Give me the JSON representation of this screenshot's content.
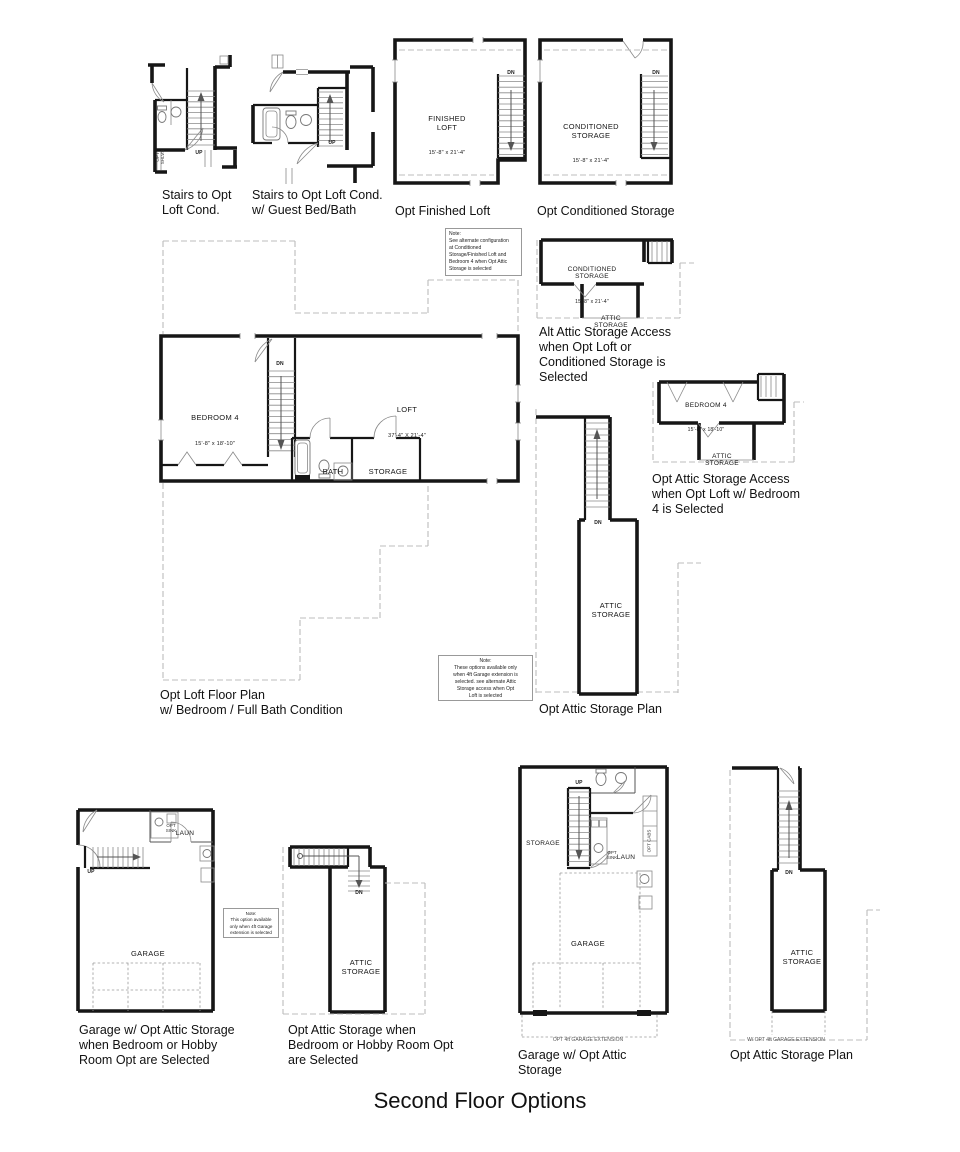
{
  "title": "Second Floor Options",
  "captions": {
    "stairs_loft": "Stairs to Opt\nLoft Cond.",
    "stairs_guest": "Stairs to Opt Loft Cond.\nw/ Guest Bed/Bath",
    "finished_loft": "Opt Finished Loft",
    "conditioned_storage": "Opt Conditioned Storage",
    "alt_attic_access": "Alt Attic Storage Access\nwhen Opt Loft or\nConditioned Storage is\nSelected",
    "attic_access_bedroom4": "Opt Attic Storage Access\nwhen Opt Loft w/ Bedroom\n4 is Selected",
    "loft_plan": "Opt Loft Floor Plan\nw/ Bedroom / Full Bath Condition",
    "attic_plan_mid": "Opt Attic Storage Plan",
    "garage_left": "Garage w/ Opt Attic Storage\nwhen Bedroom or Hobby\nRoom Opt are Selected",
    "attic_when": "Opt Attic Storage when\nBedroom or Hobby Room Opt\nare Selected",
    "garage_right": "Garage w/ Opt Attic\nStorage",
    "attic_plan_right": "Opt Attic Storage Plan"
  },
  "rooms": {
    "finished_loft": {
      "name": "FINISHED\nLOFT",
      "dims": "15'-8\" x 21'-4\""
    },
    "conditioned_storage": {
      "name": "CONDITIONED\nSTORAGE",
      "dims": "15'-8\" x 21'-4\""
    },
    "conditioned_storage_small": {
      "name": "CONDITIONED\nSTORAGE",
      "dims": "15'-8\" x 21'-4\""
    },
    "bedroom4_main": {
      "name": "BEDROOM 4",
      "dims": "15'-8\" x 18'-10\""
    },
    "bedroom4_small": {
      "name": "BEDROOM 4",
      "dims": "15'-8\" x 18'-10\""
    },
    "loft": {
      "name": "LOFT",
      "dims": "37'-4\" X 21'-4\""
    },
    "bath": "BATH",
    "storage": "STORAGE",
    "attic": "ATTIC\nSTORAGE",
    "garage": "GARAGE",
    "laun": "LAUN"
  },
  "labels": {
    "up": "UP",
    "dn": "DN",
    "opt_sink": "OPT\nSINK",
    "opt_cabs": "OPT CABS",
    "opt_shlvs": "OPT\nSHLVS",
    "garage_ext": "OPT 4ft GARAGE EXTENSION",
    "garage_ext_w": "W/ OPT 4ft GARAGE EXTENSION"
  },
  "notes": {
    "alt_config": "Note:\nSee alternate configuration\nat Conditioned\nStorage/Finished Loft and\nBedroom 4 when Opt Attic\nStorage is selected",
    "four_ft": "Note:\nThese options available only\nwhen 4ft Garage extension is\nselected. see alternate Attic\nStorage access when Opt\nLoft is selected",
    "four_ft_single": "Note:\nThis option available\nonly when 4ft Garage\nextension is selected"
  },
  "colors": {
    "line": "#161616",
    "thin": "#8a8a8a",
    "dash": "#bcbcbc"
  }
}
